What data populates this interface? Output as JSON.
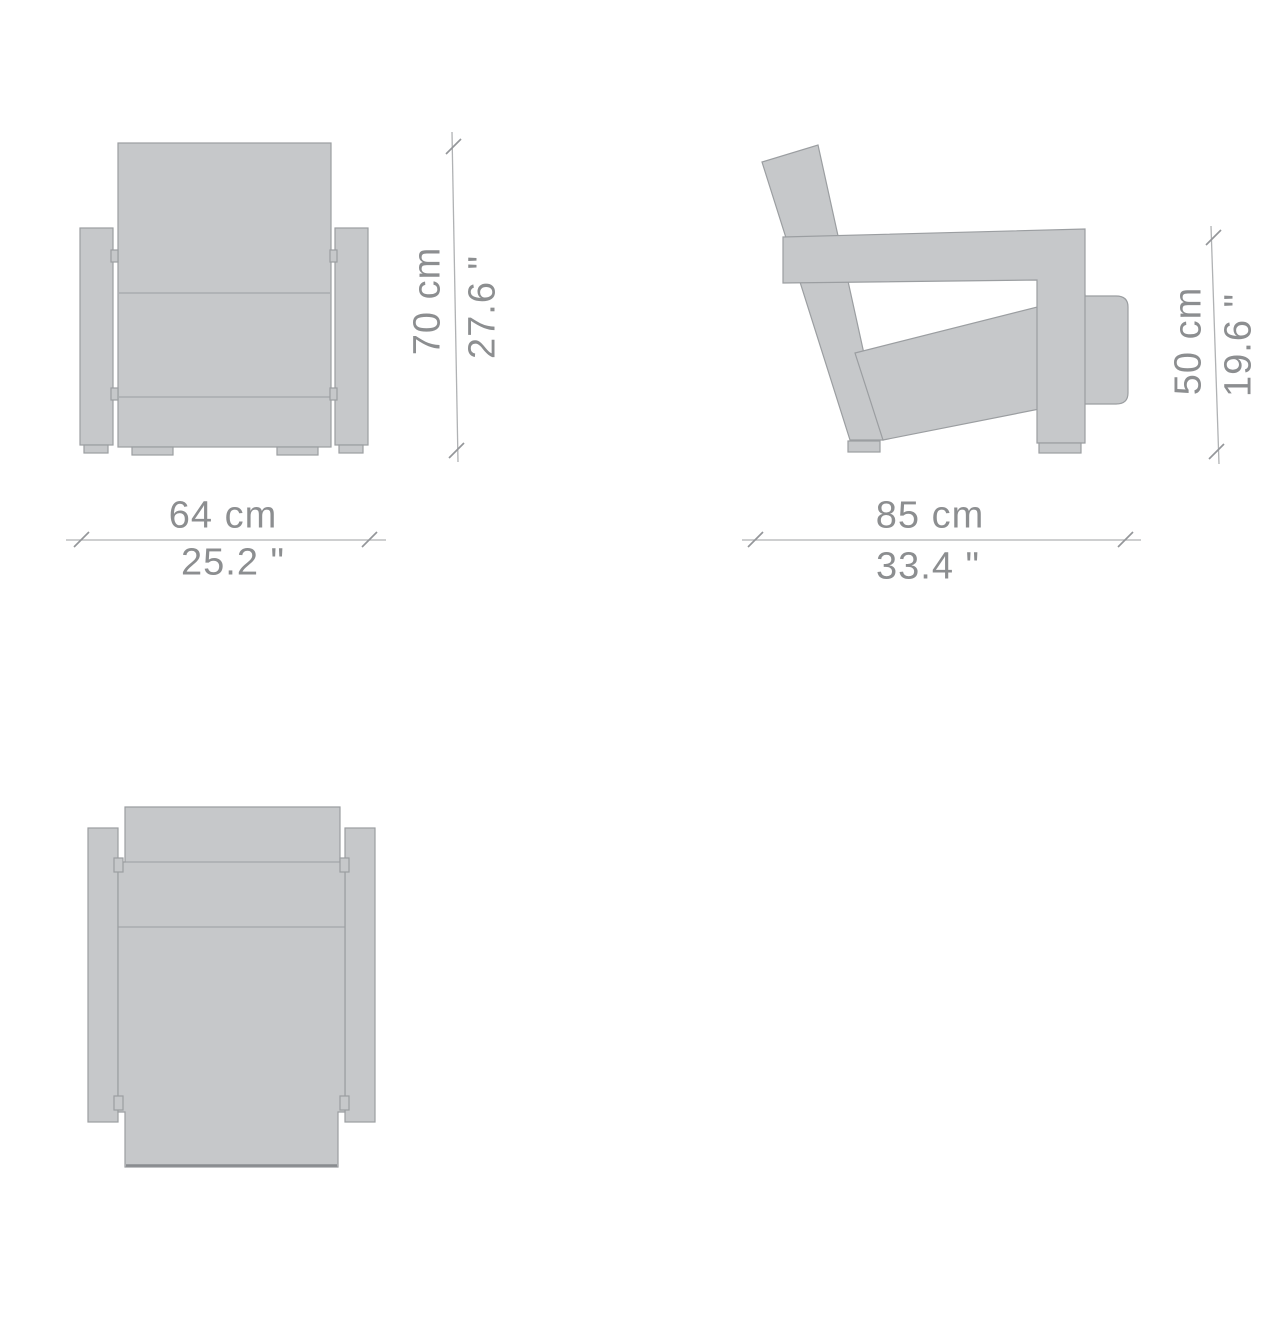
{
  "dimensions": {
    "front": {
      "height_cm": "70 cm",
      "height_in": "27.6 \"",
      "width_cm": "64 cm",
      "width_in": "25.2 \""
    },
    "side": {
      "height_cm": "50 cm",
      "height_in": "19.6 \"",
      "depth_cm": "85 cm",
      "depth_in": "33.4 \""
    }
  },
  "colors": {
    "background": "#ffffff",
    "chair_fill": "#c6c8ca",
    "chair_stroke": "#9b9ea1",
    "dark_edge": "#898c8f",
    "dim_line": "#b0b2b4",
    "dim_tick": "#94969a",
    "dim_text": "#8c8e90"
  }
}
